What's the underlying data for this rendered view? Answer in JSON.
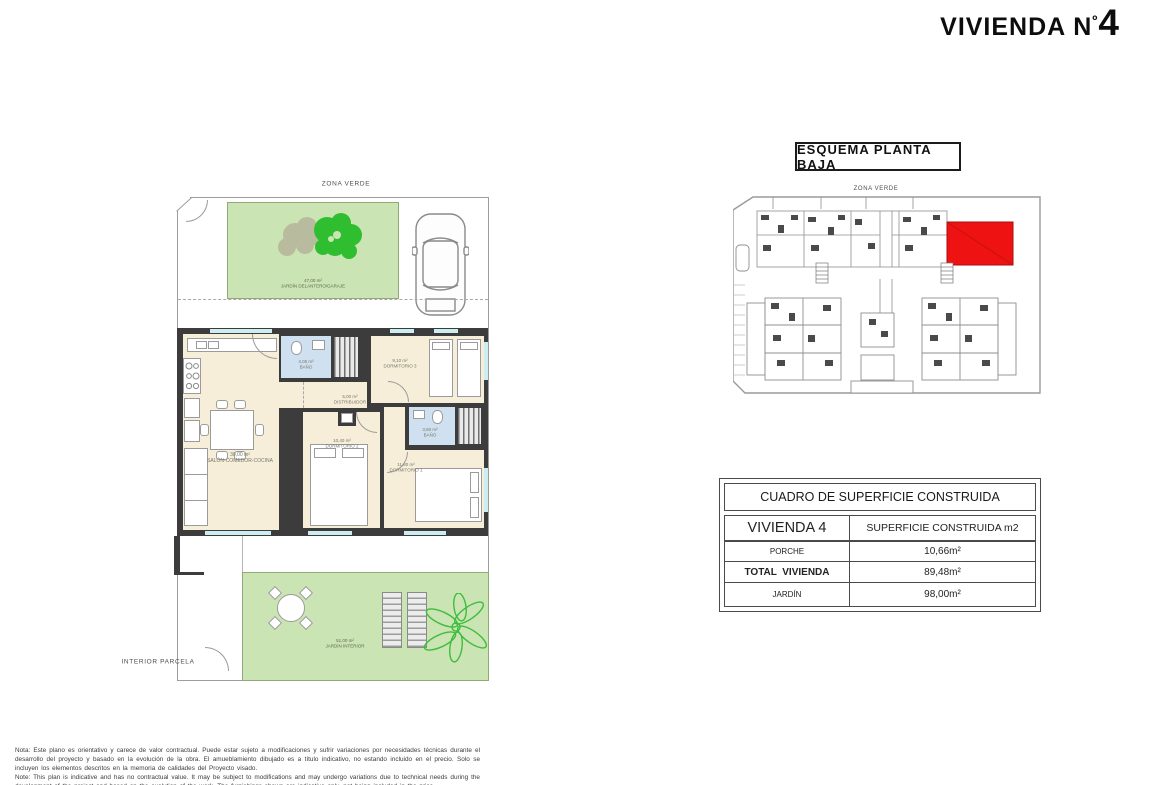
{
  "header": {
    "title_text": "VIVIENDA N",
    "title_ordinal": "º",
    "title_number": "4"
  },
  "floor_plan": {
    "zona_verde": "ZONA VERDE",
    "interior_parcela": "INTERIOR PARCELA",
    "front_garden": {
      "area": "47,00 m²",
      "name": "JARDÍN DELANTERO/GARAJE"
    },
    "interior_garden": {
      "area": "51,00 m²",
      "name": "JARDÍN INTERIOR"
    },
    "rooms": [
      {
        "area": "30,00 m²",
        "name": "SALÓN-COMEDOR-COCINA"
      },
      {
        "area": "4,05 m²",
        "name": "BAÑO"
      },
      {
        "area": "9,10 m²",
        "name": "DORMITORIO 3"
      },
      {
        "area": "5,00 m²",
        "name": "DISTRIBUIDOR"
      },
      {
        "area": "10,40 m²",
        "name": "DORMITORIO 2"
      },
      {
        "area": "3,60 m²",
        "name": "BAÑO"
      },
      {
        "area": "11,80 m²",
        "name": "DORMITORIO 1"
      }
    ]
  },
  "site_plan": {
    "title": "ESQUEMA PLANTA BAJA",
    "zona_verde": "ZONA VERDE",
    "interior_parcela": "INTERIOR PARCELA"
  },
  "surface_table": {
    "title": "CUADRO DE SUPERFICIE CONSTRUIDA",
    "col1_header": "VIVIENDA 4",
    "col2_header": "SUPERFICIE CONSTRUIDA m2",
    "rows": [
      {
        "label": "PORCHE",
        "value": "10,66m²"
      },
      {
        "label": "TOTAL  VIVIENDA",
        "value": "89,48m²"
      },
      {
        "label": "JARDÍN",
        "value": "98,00m²"
      }
    ]
  },
  "notes": {
    "spanish": "Nota: Este plano es orientativo y carece de valor contractual. Puede estar sujeto a modificaciones y sufrir variaciones por necesidades técnicas durante el desarrollo del proyecto y basado en la evolución de la obra. El amueblamiento dibujado es a título indicativo, no estando incluido en el precio. Solo se incluyen los elementos descritos en la memoria de calidades del Proyecto visado.",
    "english": "Note: This plan is indicative and has no contractual value. It may be subject to modifications and may undergo variations due to technical needs during the development of the project and based on the evolution of the work. The furnishings shown are indicative only, not being included in the price."
  },
  "colors": {
    "highlight_unit": "#ee1212",
    "garden_green": "#cbe4b3",
    "interior_cream": "#f6eed8",
    "bath_blue": "#cfe0f0",
    "window_cyan": "#cdeef0",
    "wall_dark": "#3c3c3c"
  }
}
